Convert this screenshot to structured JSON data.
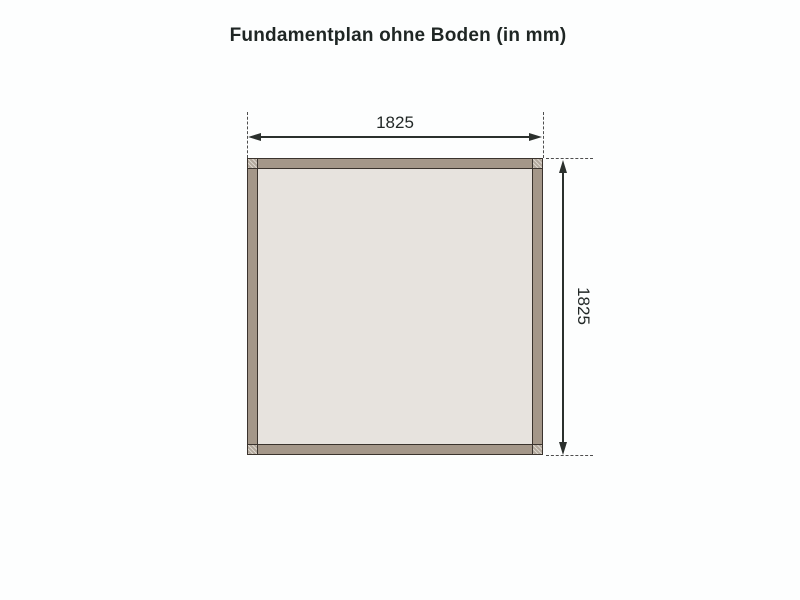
{
  "title": "Fundamentplan ohne Boden (in mm)",
  "plan": {
    "type": "foundation-plan-top-view",
    "shape": "square-frame",
    "unit": "mm",
    "width_mm": "1825",
    "height_mm": "1825"
  },
  "colors": {
    "background": "#fdfefe",
    "frame_board": "#a49789",
    "frame_corner_joint": "#b2a89c",
    "interior": "#e7e3de",
    "outline": "#3a332d",
    "dimension_lines": "#2b302d",
    "extension_dashes": "#4e4e4e",
    "title_text": "#1f2624"
  }
}
